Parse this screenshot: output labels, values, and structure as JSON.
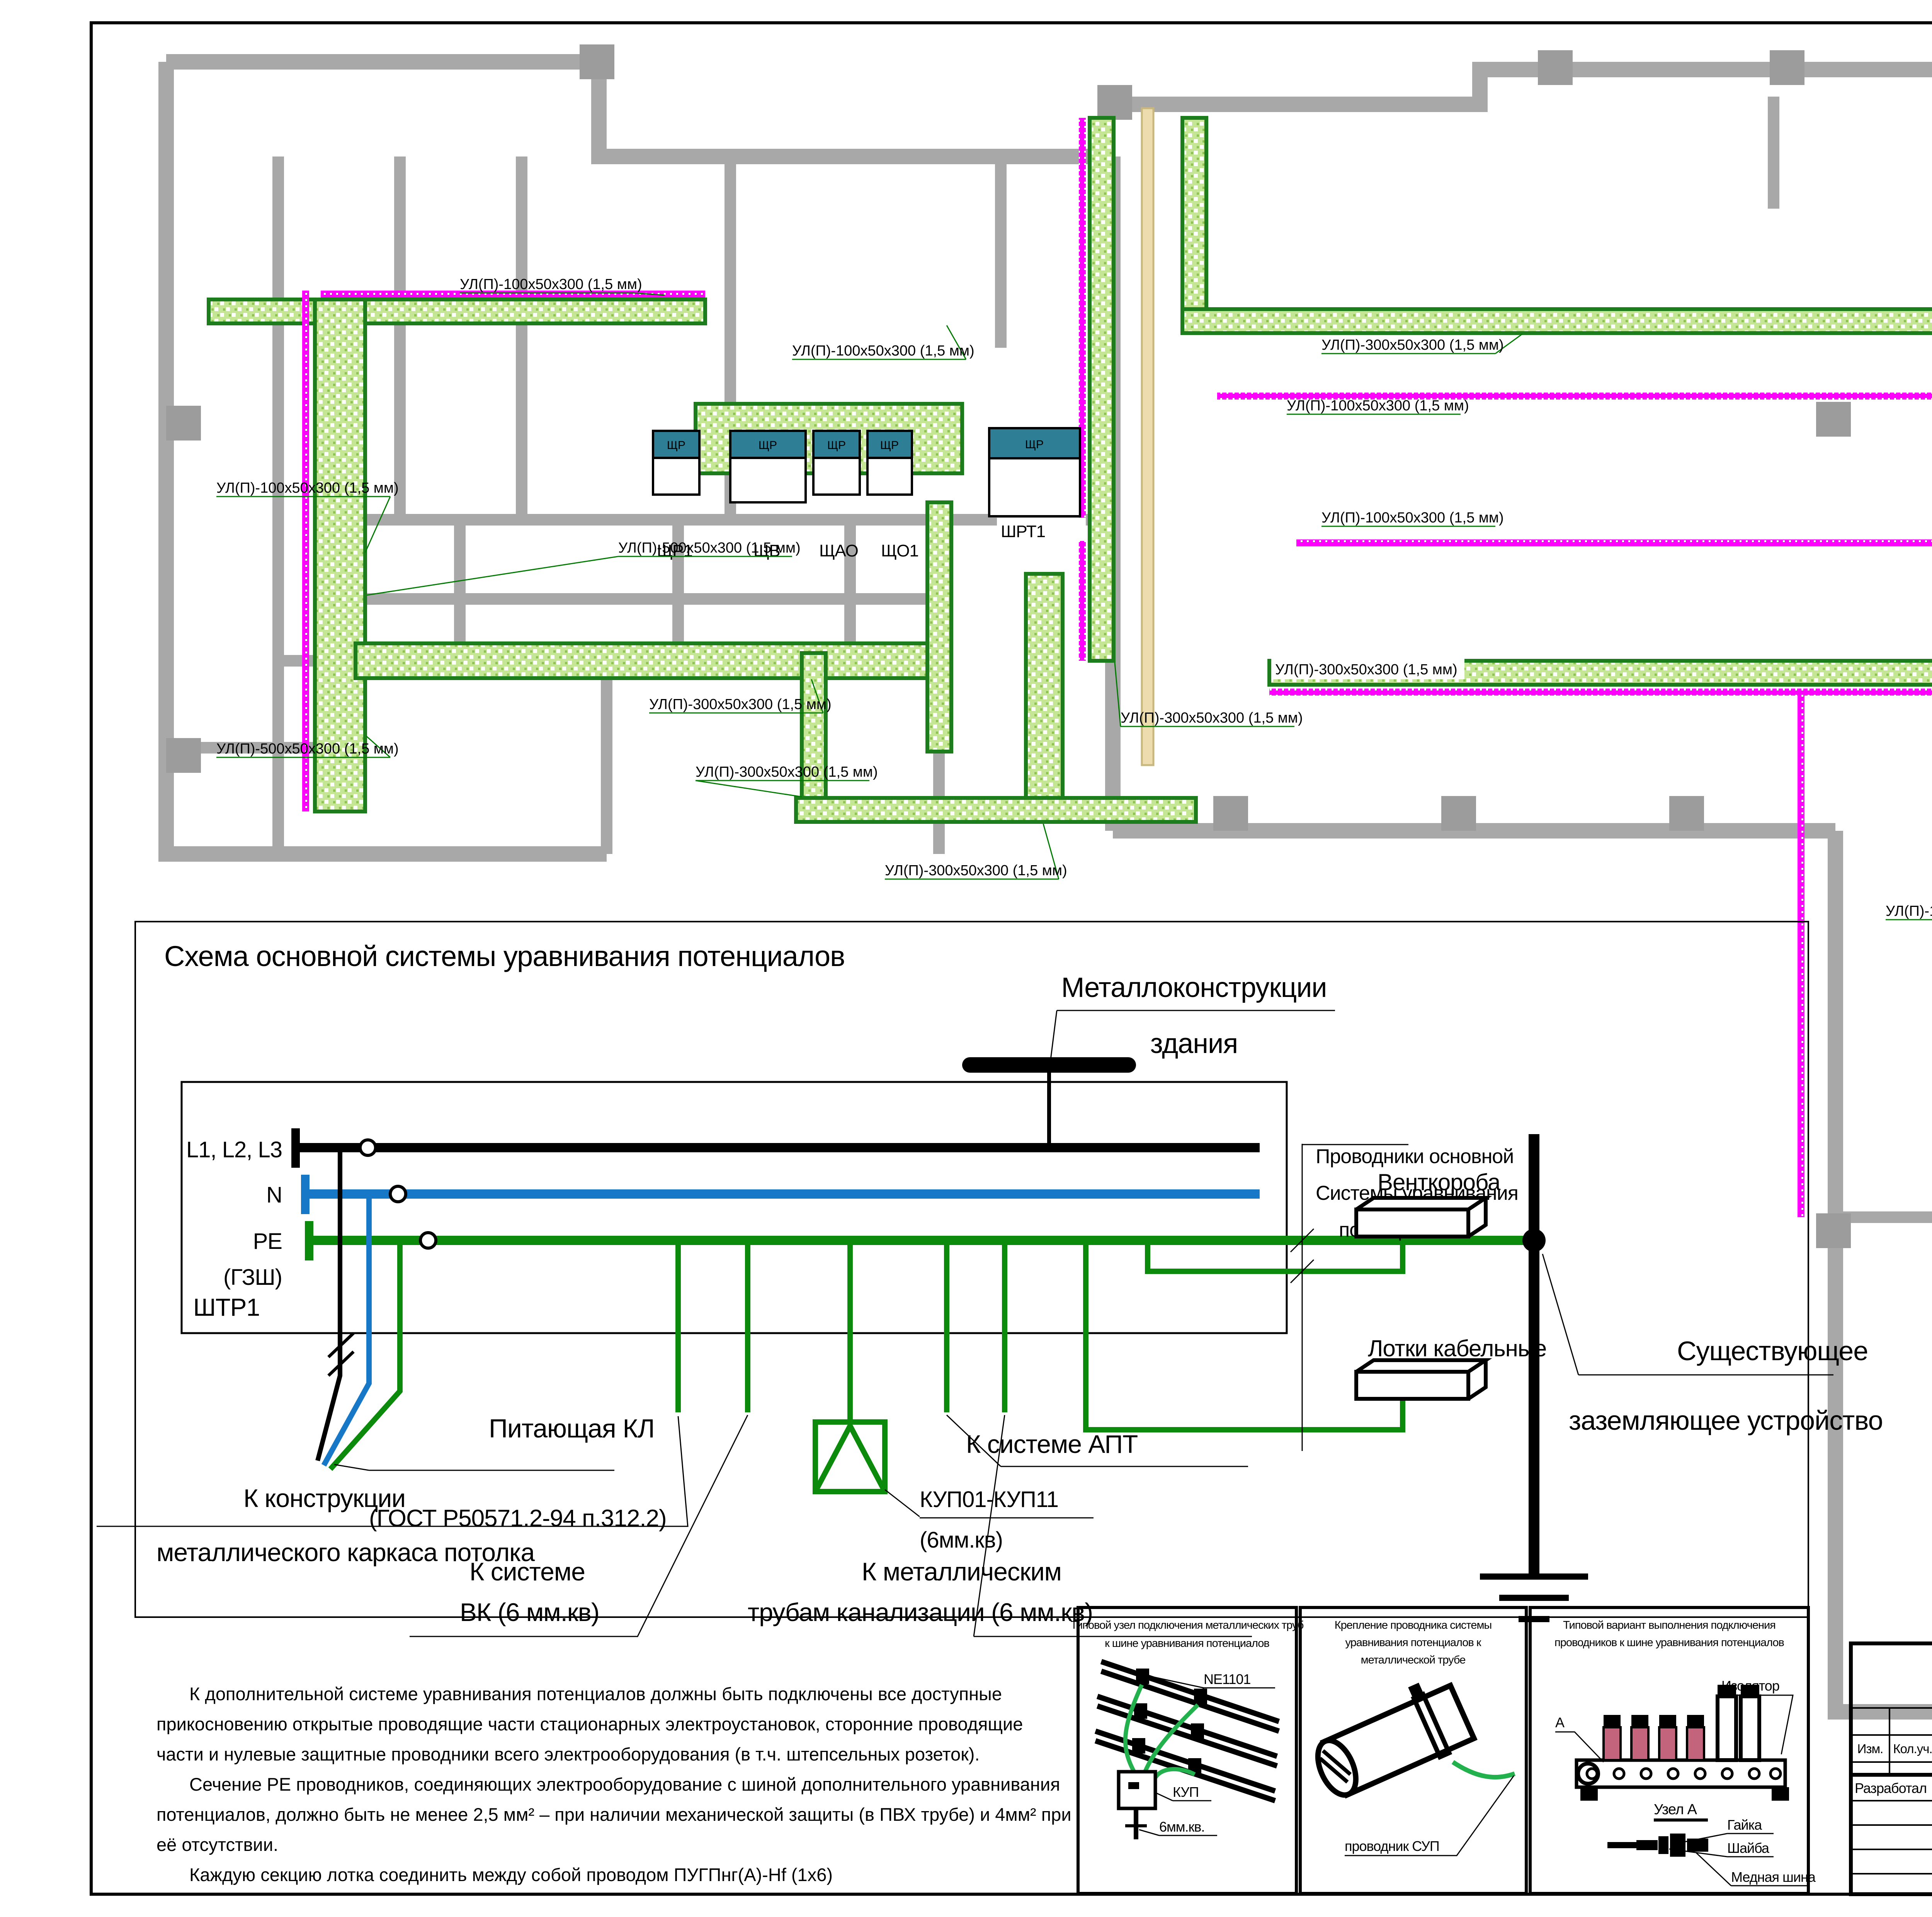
{
  "legend": {
    "i1l1": "Лоток XXXх50х300",
    "i1l2": "(1,5 мм) для силовой сети",
    "i2l1": "Лоток 100х50х300",
    "i2l2": "(1 мм)",
    "i2l3": "для сети аварийного освещения"
  },
  "plan": {
    "panel_badge": "ЩР",
    "panel_labels": [
      "ЩР1",
      "ЩВ",
      "ЩАО",
      "ЩО1",
      "ШРТ1"
    ],
    "tray_labels": [
      {
        "text": "УЛ(П)-100х50х300 (1,5 мм)"
      },
      {
        "text": "УЛ(П)-300х50х300 (1,5 мм)"
      },
      {
        "text": "УЛ(П)-100х50х300 (1,5 мм)"
      },
      {
        "text": "УЛ(П)-500х50х300 (1,5 мм)"
      },
      {
        "text": "УЛ(П)-500х50х300 (1,5 мм)"
      },
      {
        "text": "УЛ(П)-300х50х300 (1,5 мм)"
      },
      {
        "text": "УЛ(П)-300х50х300 (1,5 мм)"
      },
      {
        "text": "УЛ(П)-300х50х300 (1,5 мм)"
      },
      {
        "text": "УЛ(П)-300х50х300 (1,5 мм)"
      },
      {
        "text": "УЛ(П)-100х50х300 (1,5 мм)"
      },
      {
        "text": "УЛ(П)-100х50х300 (1,5 мм)"
      },
      {
        "text": "УЛ(П)-300х50х300 (1,5 мм)"
      },
      {
        "text": "УЛ(П)-100х50х300 (1,5 мм)"
      },
      {
        "text": "УЛ(П)-300х50х300 (1,5 мм)"
      },
      {
        "text": "УЛ(П)-100х50х300 (1,5 мм)"
      }
    ]
  },
  "schematic": {
    "title": "Схема основной системы уравнивания потенциалов",
    "shtr1": "ШТР1",
    "bus_l": "L1, L2, L3",
    "bus_n": "N",
    "bus_pe": "PE",
    "bus_pe2": "(ГЗШ)",
    "metal1": "Металлоконструкции",
    "metal2": "здания",
    "feeder1": "Питающая КЛ",
    "feeder2": "(ГОСТ Р50571.2-94 п.312.2)",
    "c1a": "К конструкции",
    "c1b": "металлического каркаса потолка",
    "c2a": "К системе",
    "c2b": "ВК (6 мм.кв)",
    "kup1": "КУП01-КУП11",
    "kup2": "(6мм.кв)",
    "c3a": "К металлическим",
    "c3b": "трубам канализации (6 мм.кв)",
    "apt": "К системе АПТ",
    "cond1": "Проводники основной",
    "cond2": "Системы уравнивания",
    "cond3": "потенциалов",
    "vent": "Венткороба",
    "trays": "Лотки кабельные",
    "exist1": "Существующее",
    "exist2": "заземляющее устройство"
  },
  "notes": {
    "l1": "К дополнительной системе уравнивания потенциалов должны быть подключены все доступные",
    "l2": "прикосновению открытые проводящие части стационарных электроустановок, сторонние проводящие",
    "l3": "части и нулевые защитные проводники всего электрооборудования (в т.ч. штепсельных розеток).",
    "l4": "Сечение PE проводников, соединяющих электрооборудование с шиной дополнительного уравнивания",
    "l5": "потенциалов, должно быть не менее 2,5 мм² – при наличии механической защиты (в ПВХ трубе) и 4мм² при",
    "l6": "её отсутствии.",
    "l7": "Каждую секцию лотка соединить между собой проводом ПУГПнг(А)-Hf (1x6)"
  },
  "details": {
    "d1": {
      "t1": "Типовой узел подключения металлических труб",
      "t2": "к шине уравнивания потенциалов",
      "a": "NE1101",
      "b": "КУП",
      "c": "6мм.кв."
    },
    "d2": {
      "t1": "Крепление проводника системы",
      "t2": "уравнивания потенциалов к",
      "t3": "металлической трубе",
      "a": "проводник СУП"
    },
    "d3": {
      "t1": "Типовой вариант выполнения подключения",
      "t2": "проводников к шине уравнивания потенциалов",
      "a": "А",
      "b": "Изолятор",
      "c": "Узел А",
      "d": "Гайка",
      "e": "Шайба",
      "f": "Медная шина"
    }
  },
  "titleblock": {
    "doc": "32-53-09Р-ЭОМ",
    "object": "Ресторан \"The ПИВО\", г. Москва, Коровинское шоссе, д.4",
    "cols": [
      "Изм.",
      "Кол.уч.",
      "Лист",
      "№ док.",
      "Подп.",
      "Дата"
    ],
    "razrab": "Разработал",
    "name": "Петров И.Н.",
    "code": "ЭОМ",
    "stage_h": "Стадия",
    "sheet_h": "Лист",
    "sheets_h": "Листов",
    "stage": "РП",
    "sheet": "15",
    "sheets": "19",
    "t1": "План прокладки кабельных лотков.",
    "t2": "Схема уравнивания потенциалов.",
    "org": "ООО «Вектор»"
  },
  "footer": {
    "kopiroval": "Копировал",
    "format": "Формат А2"
  }
}
